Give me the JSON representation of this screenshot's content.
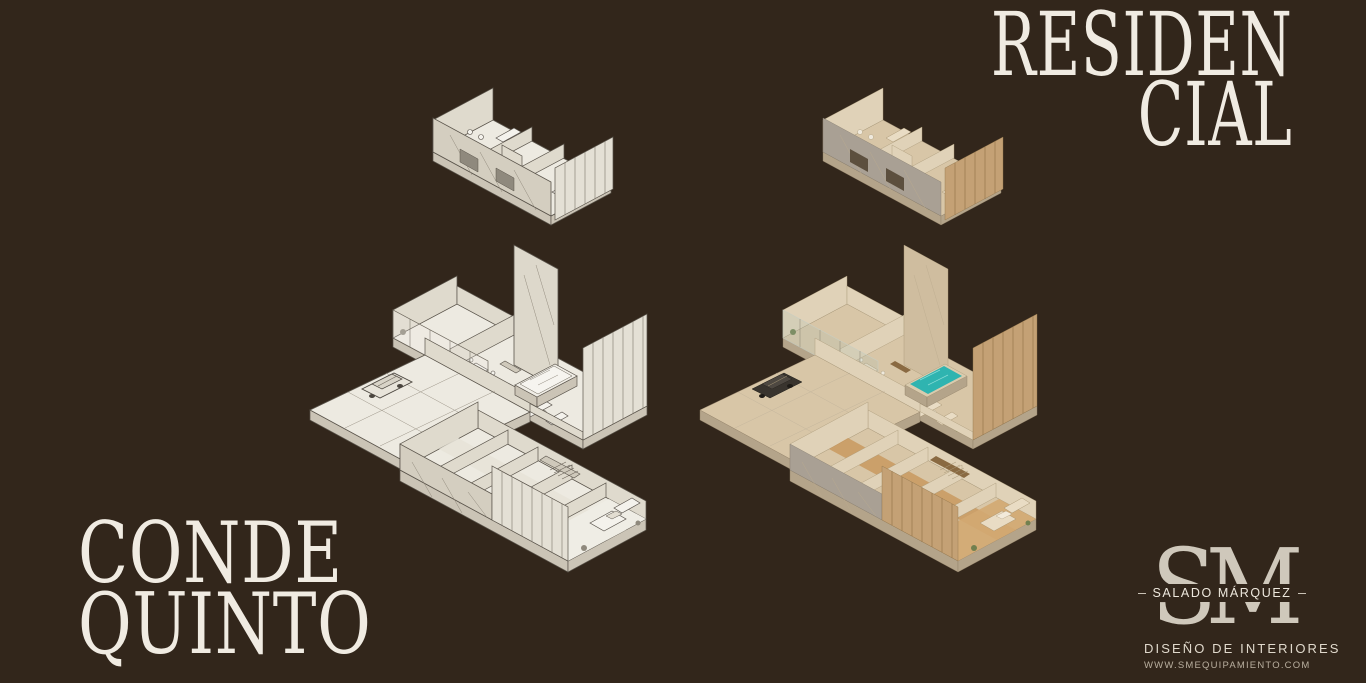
{
  "background_color": "#32261B",
  "heading": {
    "line1": "RESIDEN",
    "line2": "CIAL"
  },
  "project_title": {
    "line1": "CONDE",
    "line2": "QUINTO"
  },
  "brand": {
    "monogram": "SM",
    "studio_name": "SALADO MÁRQUEZ",
    "tagline": "DISEÑO DE INTERIORES",
    "website": "WWW.SMEQUIPAMIENTO.COM"
  },
  "illustrations": {
    "sketch_label": "exploded-isometric-floorplan-sketch",
    "render_label": "exploded-isometric-floorplan-render"
  },
  "colors": {
    "text_cream": "#F0EBE2",
    "logo_cream": "#CFC8BB",
    "pool_teal": "#2FB4B0",
    "sketch_paper": "#EDEAE1",
    "render_beige": "#D8C6A7"
  }
}
